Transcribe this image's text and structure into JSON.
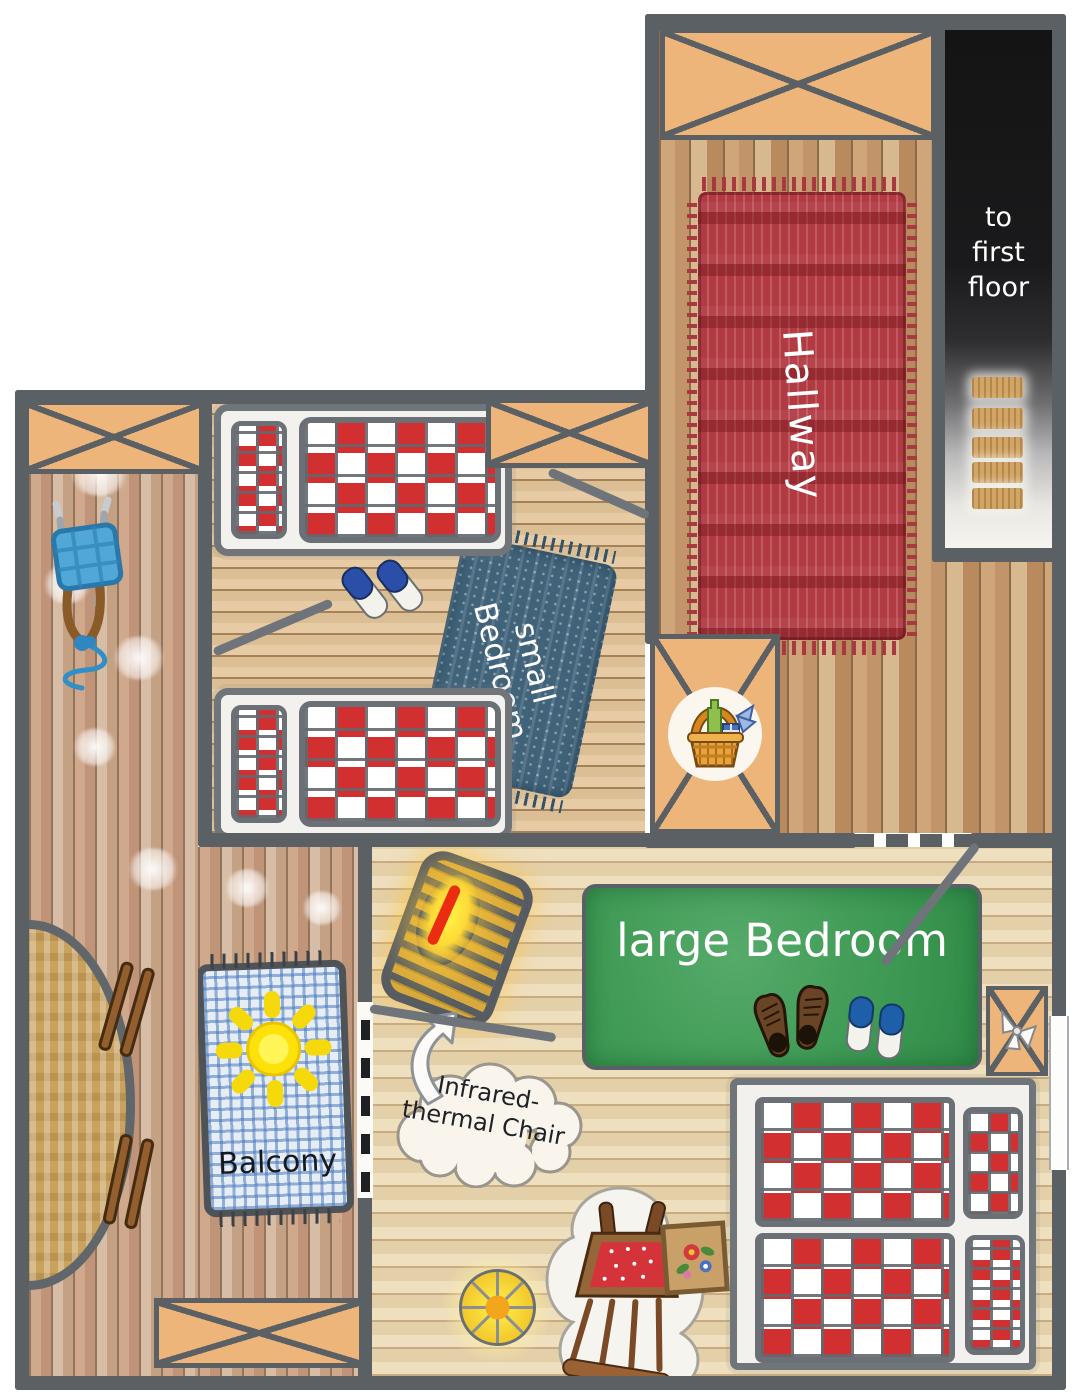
{
  "plan": {
    "title": "second floor plan",
    "rooms": {
      "hallway": {
        "label": "Hallway"
      },
      "small_bedroom": {
        "label": "small\nBedroom"
      },
      "large_bedroom": {
        "label": "large Bedroom"
      },
      "balcony": {
        "label": "Balcony"
      },
      "stairwell": {
        "label": "to\nfirst\nfloor",
        "step_count": 5
      }
    },
    "callouts": {
      "infrared_chair": "Infrared-\nthermal Chair"
    },
    "colors": {
      "wall": "#5b6065",
      "window_fill": "#edb579",
      "stair_dark": "#161616",
      "step_tan": "#d2a565",
      "hallway_rug_red": "#b23a42",
      "small_rug_blue": "#40637a",
      "large_rug_green": "#3e9a54",
      "balcony_rug_blue": "#4a7fc1",
      "quilt_red": "#d23030",
      "sun_yellow": "#ffe10a",
      "glow_yellow": "#ffd937",
      "infrared_red": "#ec2c0e"
    },
    "icons": [
      "sun-icon",
      "picnic-basket-icon",
      "sled-icon",
      "round-table-icon",
      "bench-icon",
      "single-bed-icon",
      "double-bed-icon",
      "slippers-icon",
      "shoes-icon",
      "bow-icon",
      "flower-picture-icon",
      "glow-lamp-icon",
      "sheepskin-chair-icon",
      "infrared-lounger-icon",
      "curved-arrow-icon"
    ]
  }
}
